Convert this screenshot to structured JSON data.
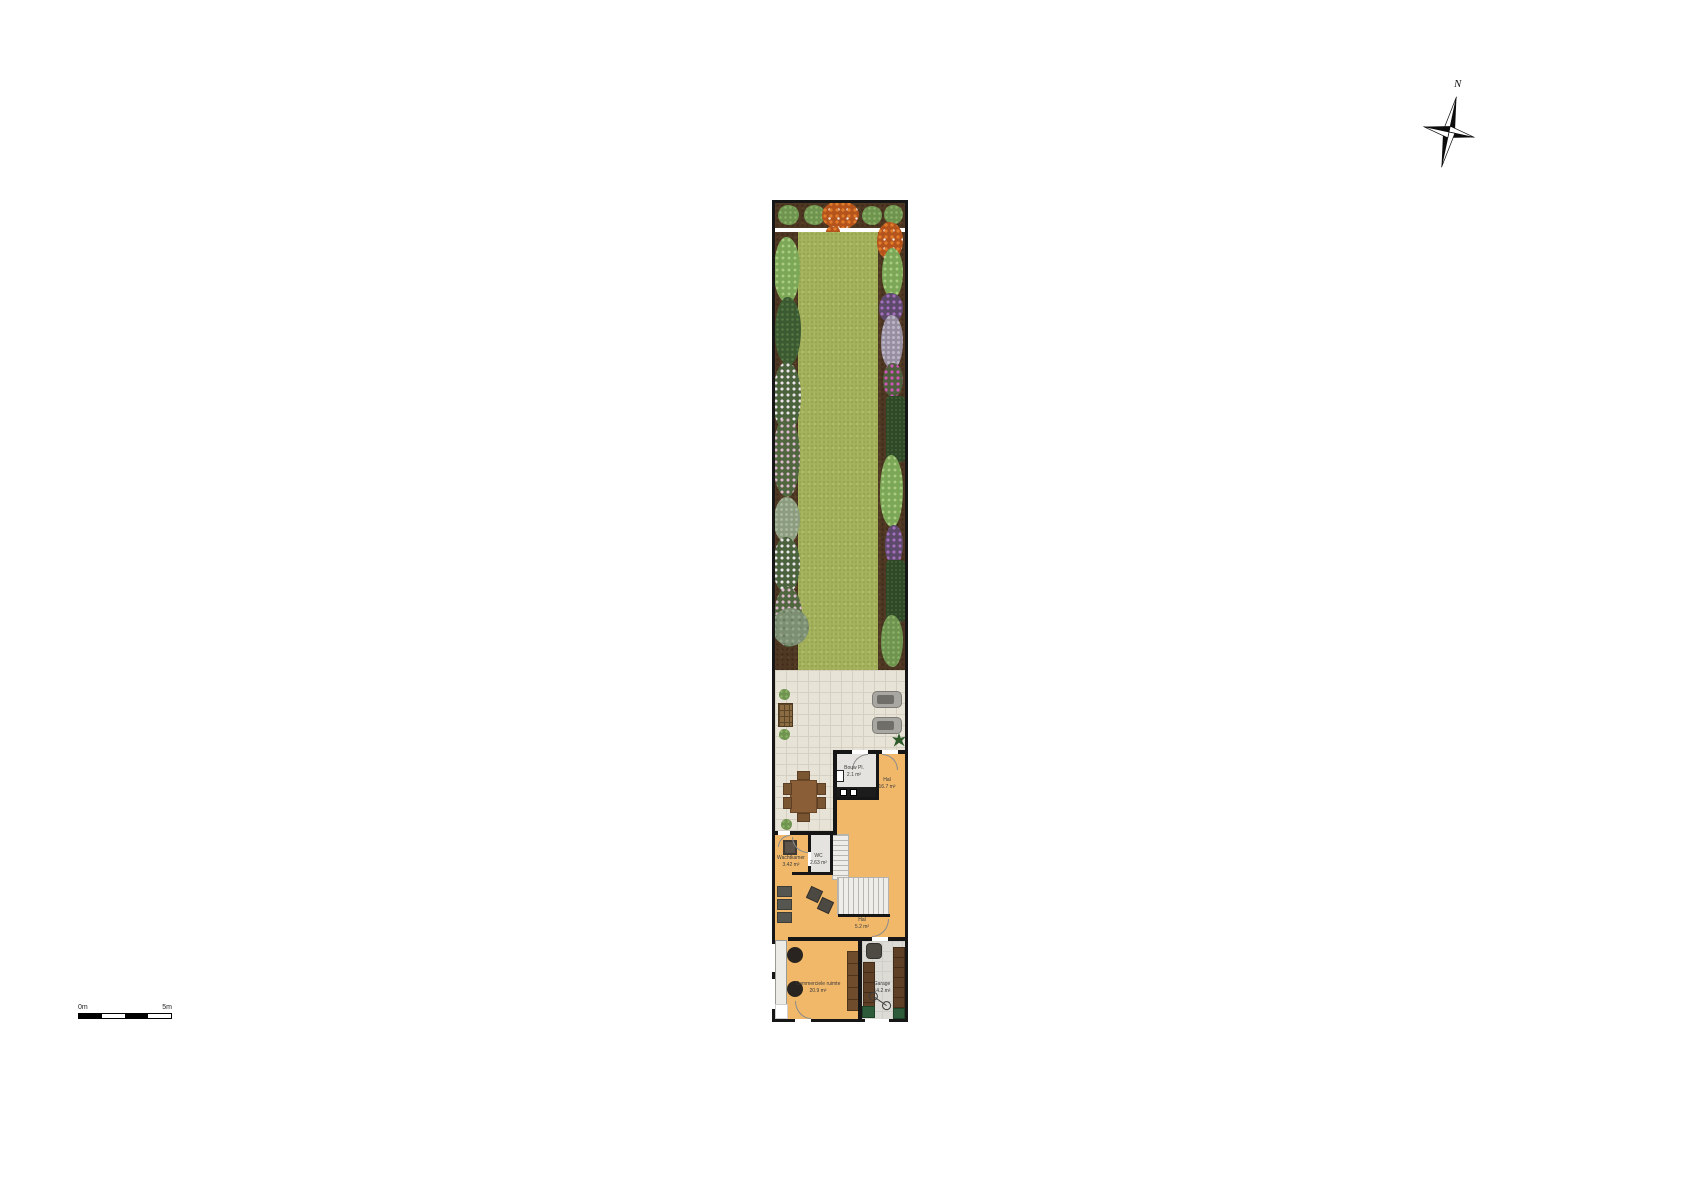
{
  "compass": {
    "north_label": "N"
  },
  "scale_bar": {
    "start_label": "0m",
    "end_label": "5m"
  },
  "rooms": {
    "bouw_pl": {
      "name": "Bouw Pl.",
      "area": "2.1 m²"
    },
    "hal": {
      "name": "Hal",
      "area": "16.7 m²"
    },
    "wachtkamer": {
      "name": "Wachtkamer",
      "area": "3.42 m²"
    },
    "wc": {
      "name": "WC",
      "area": "2.63 m²"
    },
    "hal_2": {
      "name": "Hal",
      "area": "5.2 m²"
    },
    "commerciele_ruimte": {
      "name": "Commerciele ruimte",
      "area": "20.9 m²"
    },
    "garage": {
      "name": "Garage",
      "area": "14.2 m²"
    }
  },
  "colors": {
    "lawn": "#a5b25d",
    "soil": "#4f3823",
    "patio": "#e8e3d7",
    "floor_orange": "#f1b86a",
    "floor_gray": "#e4e3df",
    "wall": "#161616"
  }
}
